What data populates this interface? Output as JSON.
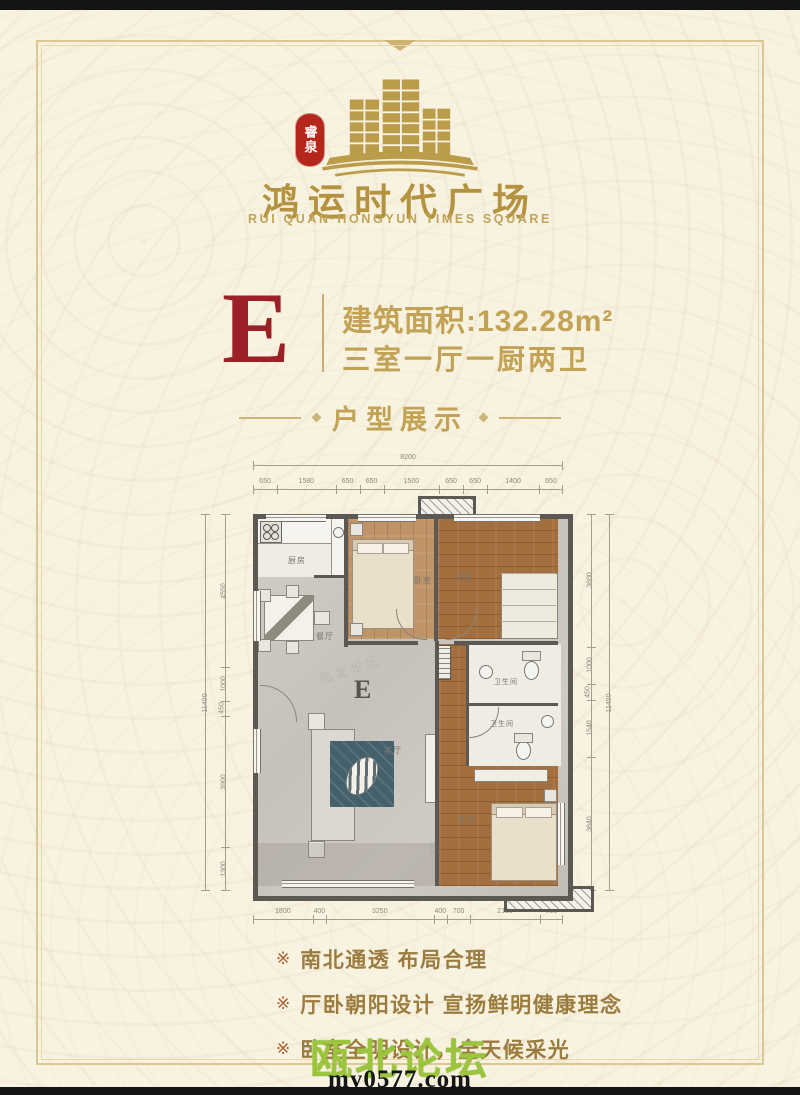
{
  "brand": {
    "seal_text": "睿泉",
    "title": "鸿运时代广场",
    "subtitle": "RUI QUAN·HONGYUN TIMES SQUARE"
  },
  "unit": {
    "letter": "E",
    "area_label": "建筑面积:132.28m²",
    "layout_label": "三室一厅一厨两卫"
  },
  "section": {
    "title": "户型展示"
  },
  "floorplan": {
    "unit_letter": "E",
    "dims_top_total": [
      "8200"
    ],
    "dims_top": [
      "650",
      "1580",
      "650",
      "650",
      "1500",
      "650",
      "650",
      "1400",
      "650"
    ],
    "dims_bottom": [
      "1800",
      "400",
      "3250",
      "400",
      "700",
      "2100",
      "700"
    ],
    "dims_left_total": [
      "11400"
    ],
    "dims_left": [
      "4550",
      "1000",
      "450",
      "3900",
      "1300"
    ],
    "dims_right": [
      "3600",
      "1000",
      "450",
      "1540",
      "3640"
    ],
    "dims_right_total": [
      "11400"
    ],
    "rooms": {
      "kitchen": "厨房",
      "dining": "餐厅",
      "bedroom_center": "卧室",
      "bedroom_right": "主卧",
      "living": "客厅",
      "bath_upper": "卫生间",
      "bath_lower": "卫生间",
      "bedroom_bottom": "卧室"
    }
  },
  "features": {
    "bullet": "※",
    "items": [
      "南北通透 布局合理",
      "厅卧朝阳设计 宣扬鲜明健康理念",
      "卧室全明设计，全天候采光"
    ]
  },
  "watermark": {
    "site_name": "瓯北论坛",
    "site_url": "my0577.com"
  },
  "colors": {
    "gold": "#c2a255",
    "title_gold": "#b4923f",
    "seal_red": "#b5271c",
    "letter_red": "#9b2126",
    "wall_gray": "#5c5955",
    "wood_brown": "#a46f3e",
    "wood_tan": "#bf9468",
    "marble_gray": "#cbc6bf",
    "rug_teal": "#43606b",
    "watermark_green": "#9cc53e",
    "feature_text": "#9b7c3e"
  }
}
